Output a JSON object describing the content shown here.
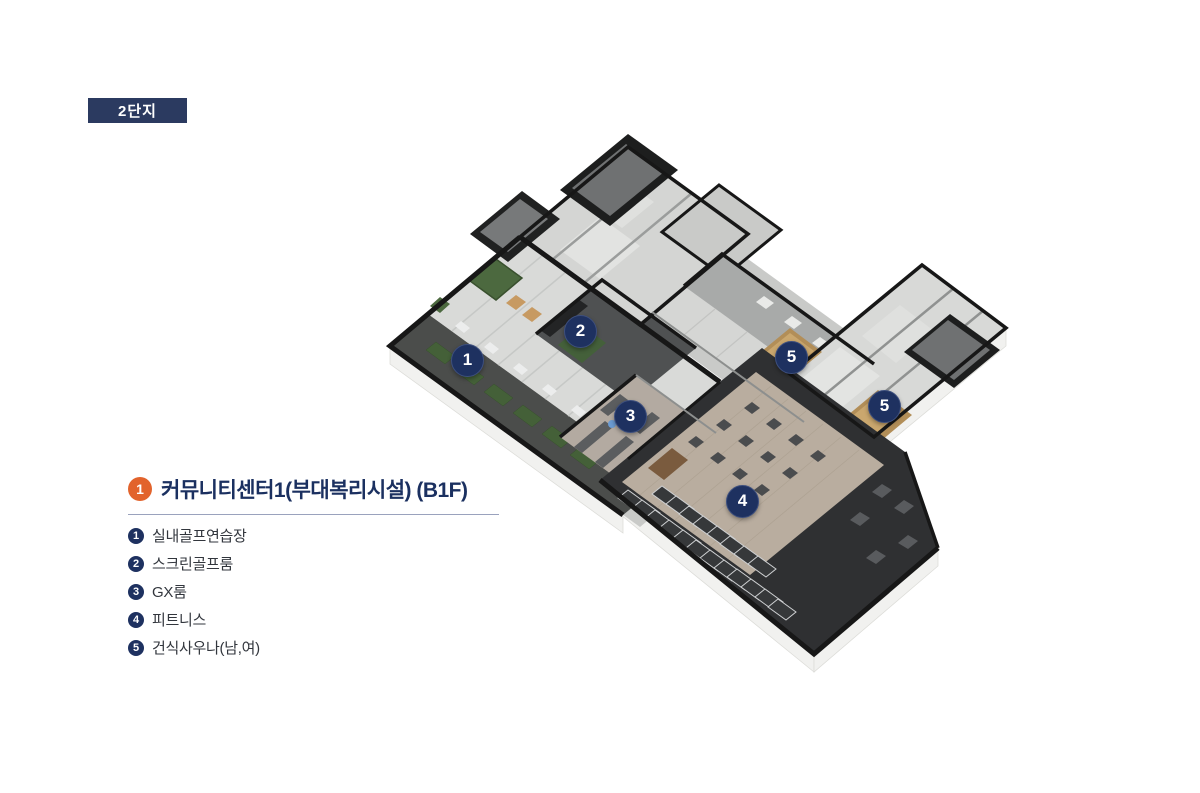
{
  "page": {
    "background_color": "#ffffff"
  },
  "complex_badge": {
    "label": "2단지",
    "bg_color": "#2b3a60",
    "text_color": "#ffffff"
  },
  "floor_plan": {
    "marker_color": "#1e3160",
    "marker_text_color": "#ffffff",
    "markers": [
      {
        "number": "1",
        "x": 467,
        "y": 360
      },
      {
        "number": "2",
        "x": 580,
        "y": 331
      },
      {
        "number": "3",
        "x": 630,
        "y": 416
      },
      {
        "number": "4",
        "x": 742,
        "y": 501
      },
      {
        "number": "5",
        "x": 791,
        "y": 357
      },
      {
        "number": "5",
        "x": 884,
        "y": 406
      }
    ]
  },
  "legend": {
    "title": {
      "bullet_number": "1",
      "bullet_color": "#e2632c",
      "label": "커뮤니티센터1(부대복리시설) (B1F)"
    },
    "divider_color": "#9aa2bd",
    "item_bullet_color": "#1e3160",
    "items": [
      {
        "number": "1",
        "label": "실내골프연습장"
      },
      {
        "number": "2",
        "label": "스크린골프룸"
      },
      {
        "number": "3",
        "label": "GX룸"
      },
      {
        "number": "4",
        "label": "피트니스"
      },
      {
        "number": "5",
        "label": "건식사우나(남,여)"
      }
    ]
  }
}
